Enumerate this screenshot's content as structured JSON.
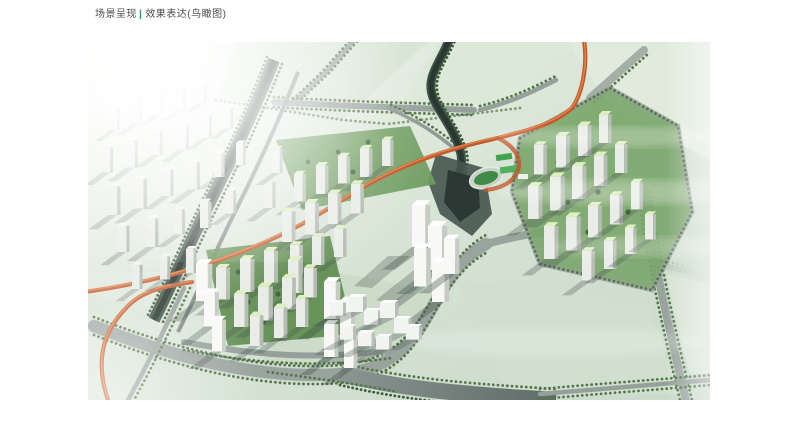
{
  "header": {
    "title_part1": "场景呈现",
    "separator": "|",
    "title_part2": "效果表达(鸟瞰图)",
    "text_color": "#4c4c4c",
    "separator_color": "#2f9e72"
  },
  "image": {
    "palette": {
      "mist_background": "#dde9db",
      "field_green": "#d1e0ce",
      "road_gray": "#9aa49f",
      "water_dark": "#1e2a26",
      "tree_green": "#55754b",
      "expressway_orange": "#c2592a",
      "tower_facade": "#eef0ec",
      "tower_roof_green": "#dff0bf",
      "courtyard_green": "#5f8d50",
      "sports_field_green": "#3f8a46"
    },
    "features": [
      "left-city-cluster",
      "central-residential-towers",
      "landmark-towers",
      "south-residential-cluster",
      "commercial-blocks",
      "right-residential-cluster",
      "sports-field",
      "river-canal",
      "orange-expressway",
      "road-network",
      "sun-glare"
    ]
  }
}
